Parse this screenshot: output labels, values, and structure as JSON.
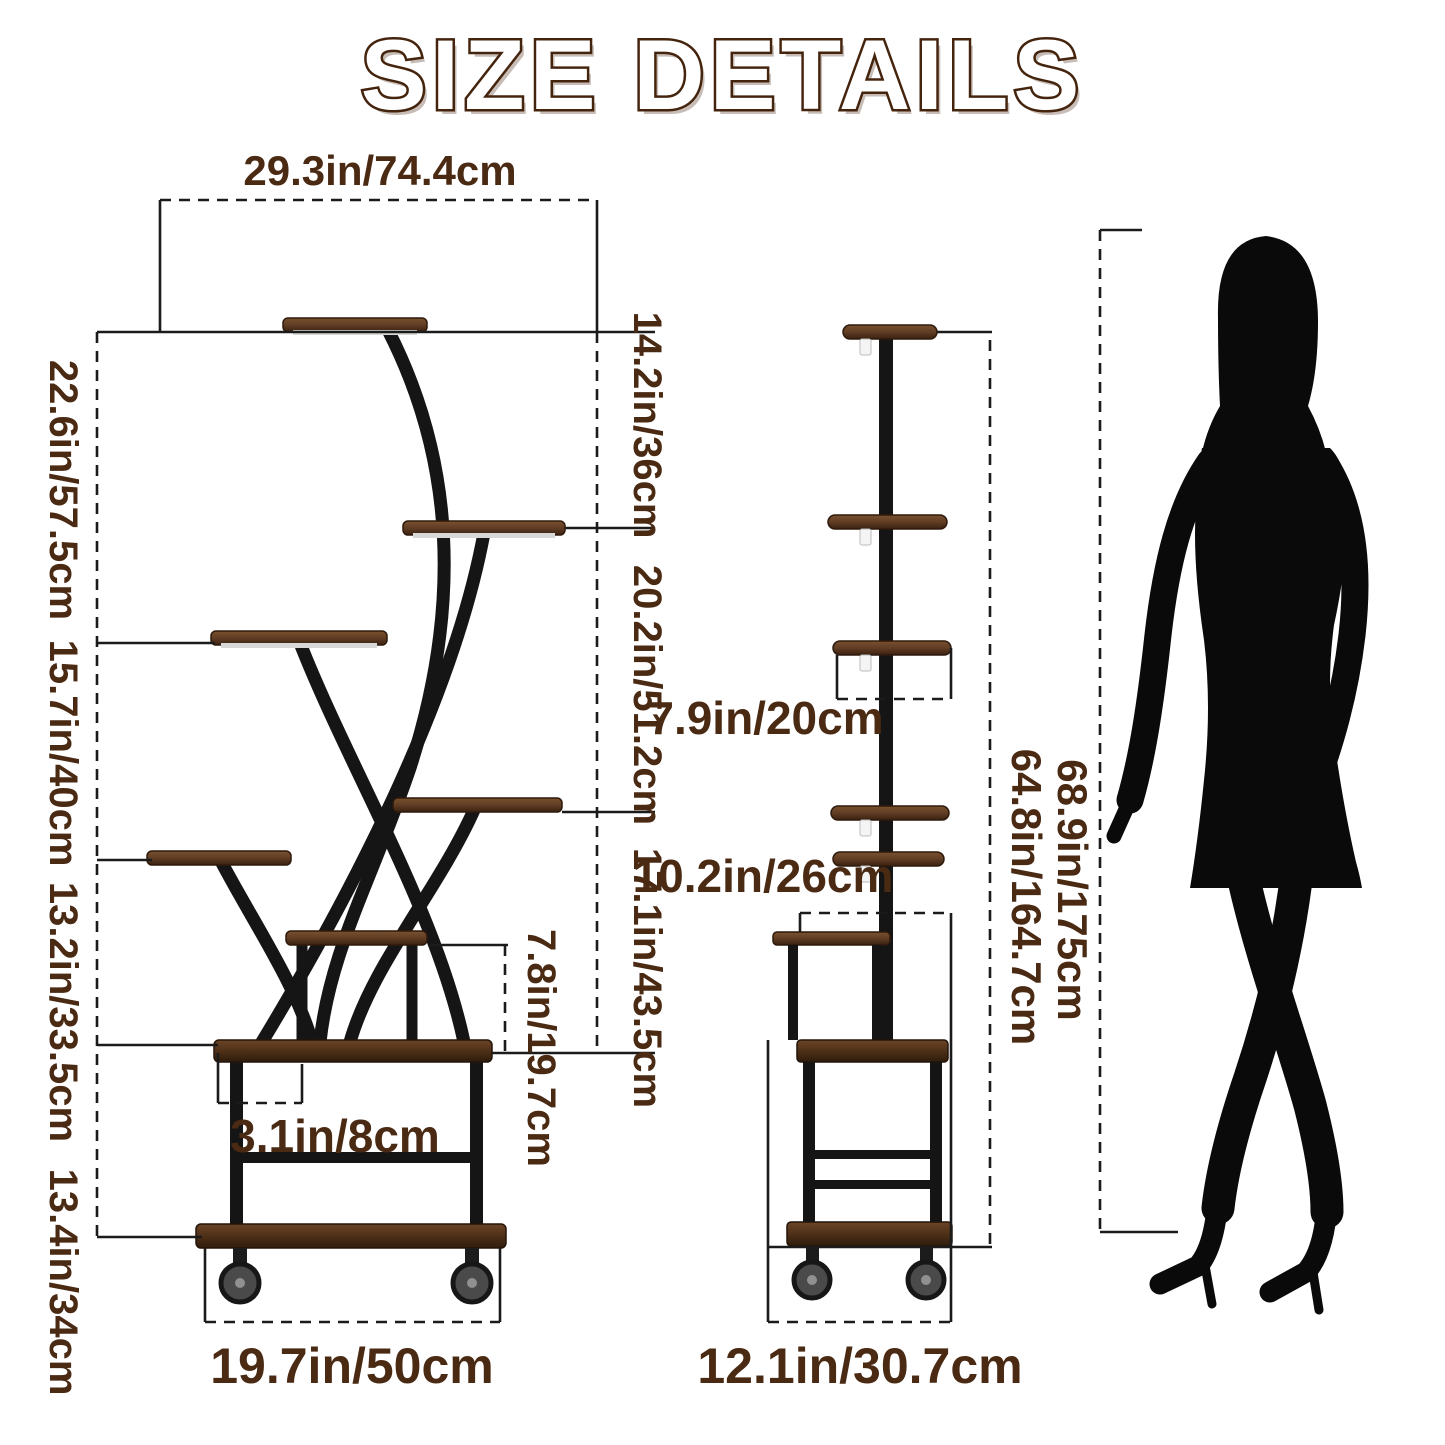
{
  "title": "SIZE DETAILS",
  "front_view": {
    "top_width": "29.3in/74.4cm",
    "height_segments_left": [
      "22.6in/57.5cm",
      "15.7in/40cm",
      "13.2in/33.5cm",
      "13.4in/34cm"
    ],
    "height_segments_right": [
      "14.2in/36cm",
      "20.2in/51.2cm",
      "17.1in/43.5cm"
    ],
    "small_shelf_height": "7.8in/19.7cm",
    "leg_inset": "3.1in/8cm",
    "bottom_width": "19.7in/50cm"
  },
  "side_view": {
    "shelf_depth": "7.9in/20cm",
    "base_top_depth": "10.2in/26cm",
    "frame_height": "64.8in/164.7cm",
    "base_depth": "12.1in/30.7cm"
  },
  "comparison": {
    "total_height": "68.9in/175cm"
  },
  "colors": {
    "label": "#4a2a13",
    "line": "#1b1b1b",
    "frame": "#151515",
    "wood": "#6a4426",
    "wood_dark": "#3a2210",
    "title_outline": "#45240e"
  }
}
